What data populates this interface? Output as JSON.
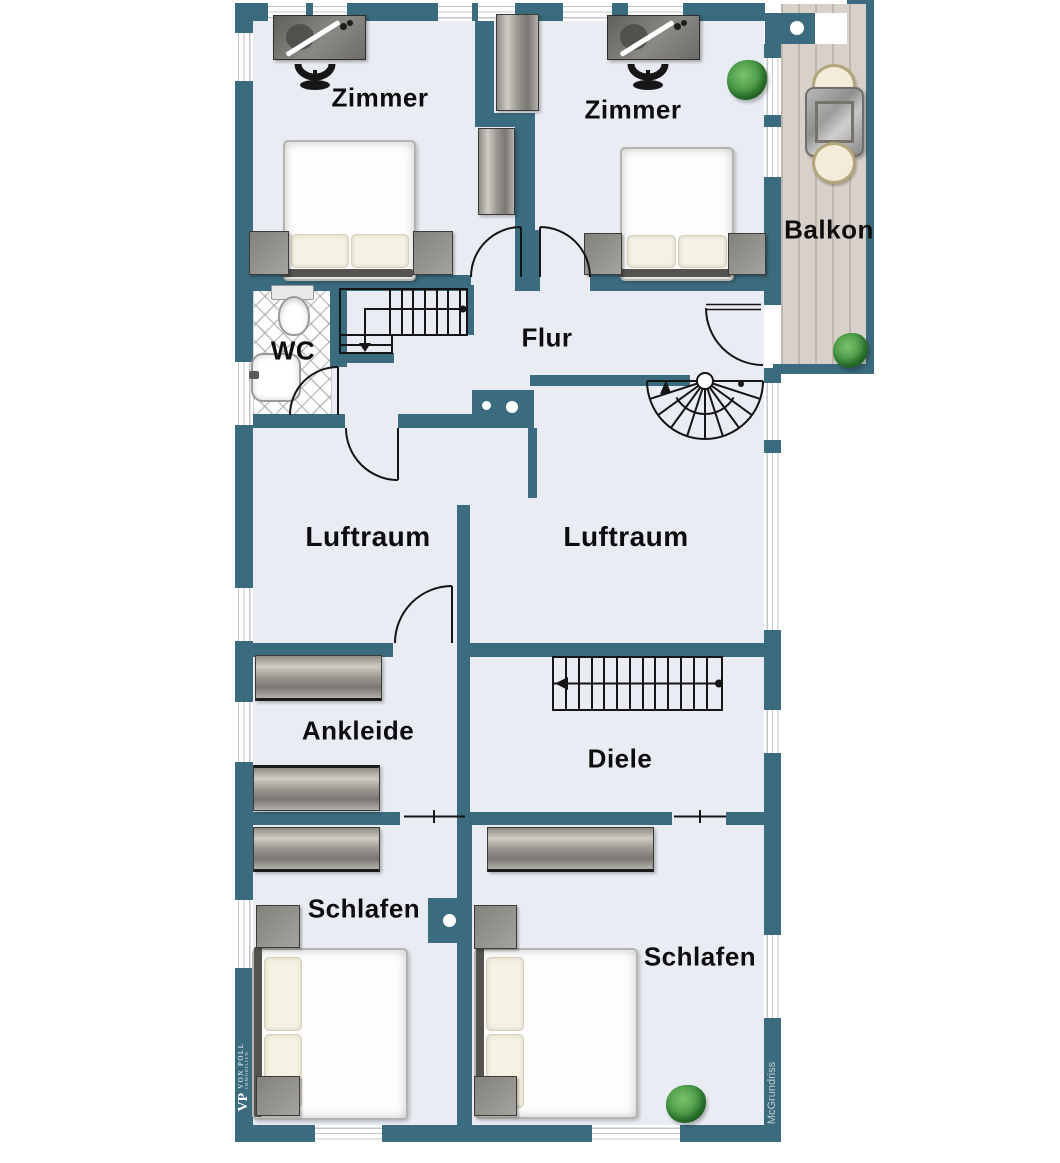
{
  "rooms": {
    "zimmer_left": "Zimmer",
    "zimmer_right": "Zimmer",
    "balkon": "Balkon",
    "wc": "WC",
    "flur": "Flur",
    "luftraum_left": "Luftraum",
    "luftraum_right": "Luftraum",
    "ankleide": "Ankleide",
    "diele": "Diele",
    "schlafen_left": "Schlafen",
    "schlafen_right": "Schlafen"
  },
  "watermarks": {
    "logo_initials": "VP",
    "brand": "VON POLL",
    "brand_sub": "IMMOBILIEN",
    "credit": "McGrundriss"
  },
  "colors": {
    "wall_teal": "#3b6b7e",
    "floor": "#e9edf3",
    "balcony_wood": "#d8d1ca",
    "linework": "#151515",
    "label_text": "#0d0d0d"
  }
}
